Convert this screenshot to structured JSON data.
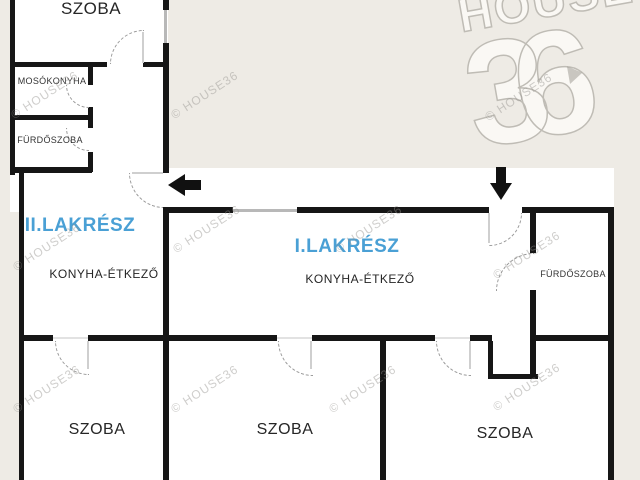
{
  "document_type": "floor-plan",
  "colors": {
    "background": "#eeebe5",
    "interior": "#ffffff",
    "wall": "#161616",
    "unit_label_blue": "#4aa0d5",
    "room_text": "#262626",
    "watermark_gray": "#94928e"
  },
  "watermark_text": "© HOUSE36",
  "logo": {
    "line1": "HOUSE",
    "line2": "36"
  },
  "rooms": [
    {
      "name": "top-left-room",
      "label": "SZOBA"
    },
    {
      "name": "laundry-kitchen",
      "label": "MOSÓKONYHA"
    },
    {
      "name": "bathroom-unit2",
      "label": "FÜRDŐSZOBA"
    },
    {
      "name": "unit2",
      "label": "II.LAKRÉSZ",
      "sublabel": "KONYHA-ÉTKEZŐ"
    },
    {
      "name": "unit1",
      "label": "I.LAKRÉSZ",
      "sublabel": "KONYHA-ÉTKEZŐ"
    },
    {
      "name": "bathroom-unit1",
      "label": "FÜRDŐSZOBA"
    },
    {
      "name": "bedroom-left",
      "label": "SZOBA"
    },
    {
      "name": "bedroom-middle",
      "label": "SZOBA"
    },
    {
      "name": "bedroom-right",
      "label": "SZOBA"
    }
  ]
}
